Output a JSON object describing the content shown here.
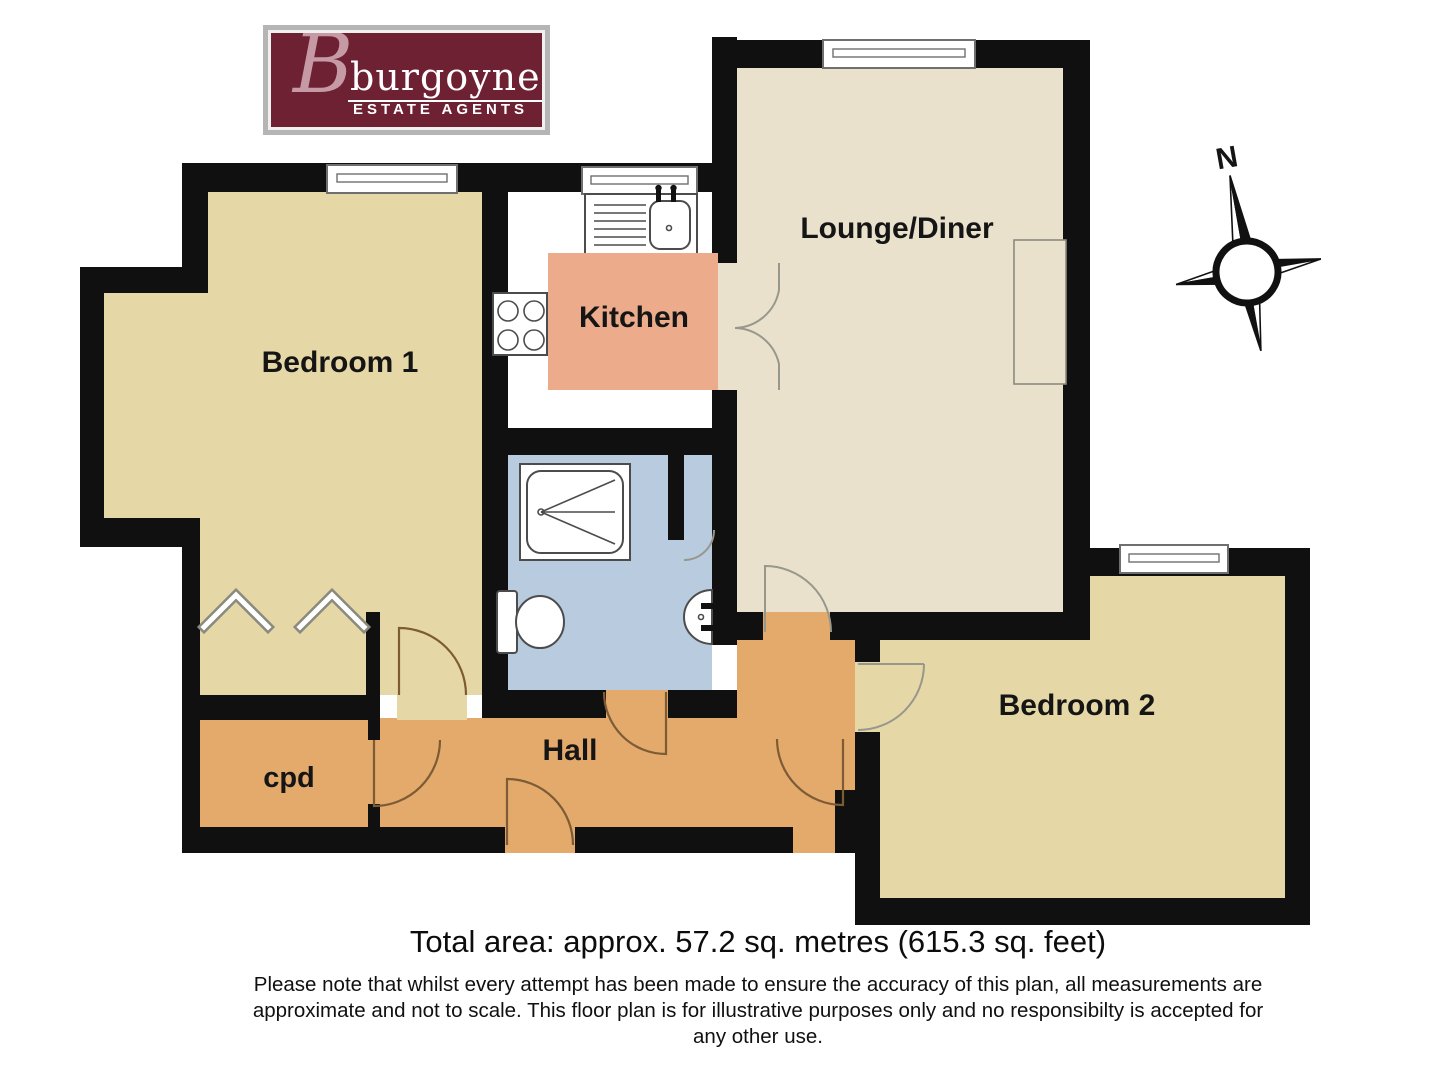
{
  "logo": {
    "initial": "B",
    "name": "burgoynes",
    "tagline": "ESTATE AGENTS"
  },
  "compass": {
    "north_label": "N"
  },
  "rooms": {
    "bedroom1": {
      "label": "Bedroom 1"
    },
    "kitchen": {
      "label": "Kitchen"
    },
    "lounge": {
      "label": "Lounge/Diner"
    },
    "bedroom2": {
      "label": "Bedroom 2"
    },
    "hall": {
      "label": "Hall"
    },
    "cpd": {
      "label": "cpd"
    }
  },
  "footer": {
    "total_area": "Total area: approx. 57.2 sq. metres (615.3 sq. feet)",
    "disclaimer_line1": "Please note that whilst every attempt has been made to ensure the accuracy of this plan, all measurements are",
    "disclaimer_line2": "approximate and not to scale. This floor plan is for illustrative purposes only and no responsibilty is accepted for",
    "disclaimer_line3": "any other use."
  },
  "colors": {
    "wall": "#101010",
    "bedroom": "#e6d8a6",
    "lounge": "#e9e1cc",
    "hall": "#e3aa6c",
    "bathroom": "#b8cbdf",
    "kitchen_floor": "#ffffff",
    "kitchen_box": "#ecab8b",
    "logo_maroon": "#6f2134"
  }
}
